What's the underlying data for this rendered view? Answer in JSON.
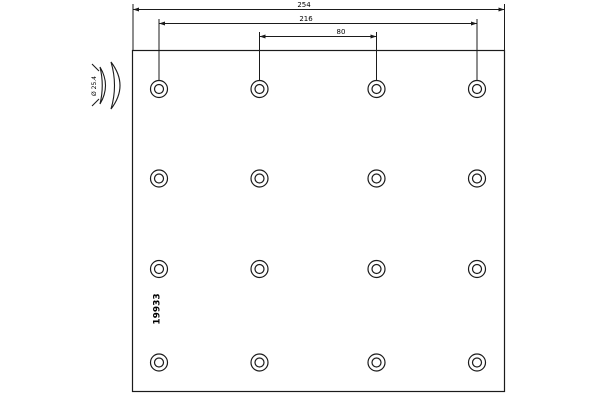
{
  "background": "#ffffff",
  "line_color": "#1b1b1b",
  "plate": {
    "x": 132.5,
    "y": 50.5,
    "width": 372,
    "height": 341
  },
  "holes": {
    "columns": [
      159,
      259.5,
      376.5,
      477
    ],
    "rows": [
      89,
      178.5,
      269,
      362.5
    ],
    "outer_radius": 8.5,
    "inner_radius": 4.5
  },
  "dimensions": [
    {
      "label": "254",
      "y": 9.5,
      "x1": 133,
      "x2": 504.5,
      "ext_top": 4,
      "ext_bottom": 50,
      "label_x": 304,
      "label_y": 7
    },
    {
      "label": "216",
      "y": 23.5,
      "x1": 159,
      "x2": 477,
      "ext_top": 19,
      "ext_bottom": 80,
      "label_x": 306,
      "label_y": 21
    },
    {
      "label": "80",
      "y": 36.5,
      "x1": 259.5,
      "x2": 376.5,
      "ext_top": 32,
      "ext_bottom": 81,
      "label_x": 341,
      "label_y": 34
    }
  ],
  "part_label": {
    "text": "19933",
    "x": 157,
    "y": 309,
    "rotation": -90,
    "font_size": 9
  },
  "profile_icon": {
    "label": "Ø 25.4",
    "label_x": 94.5,
    "label_y": 86,
    "rotation": -90,
    "font_size": 6
  }
}
